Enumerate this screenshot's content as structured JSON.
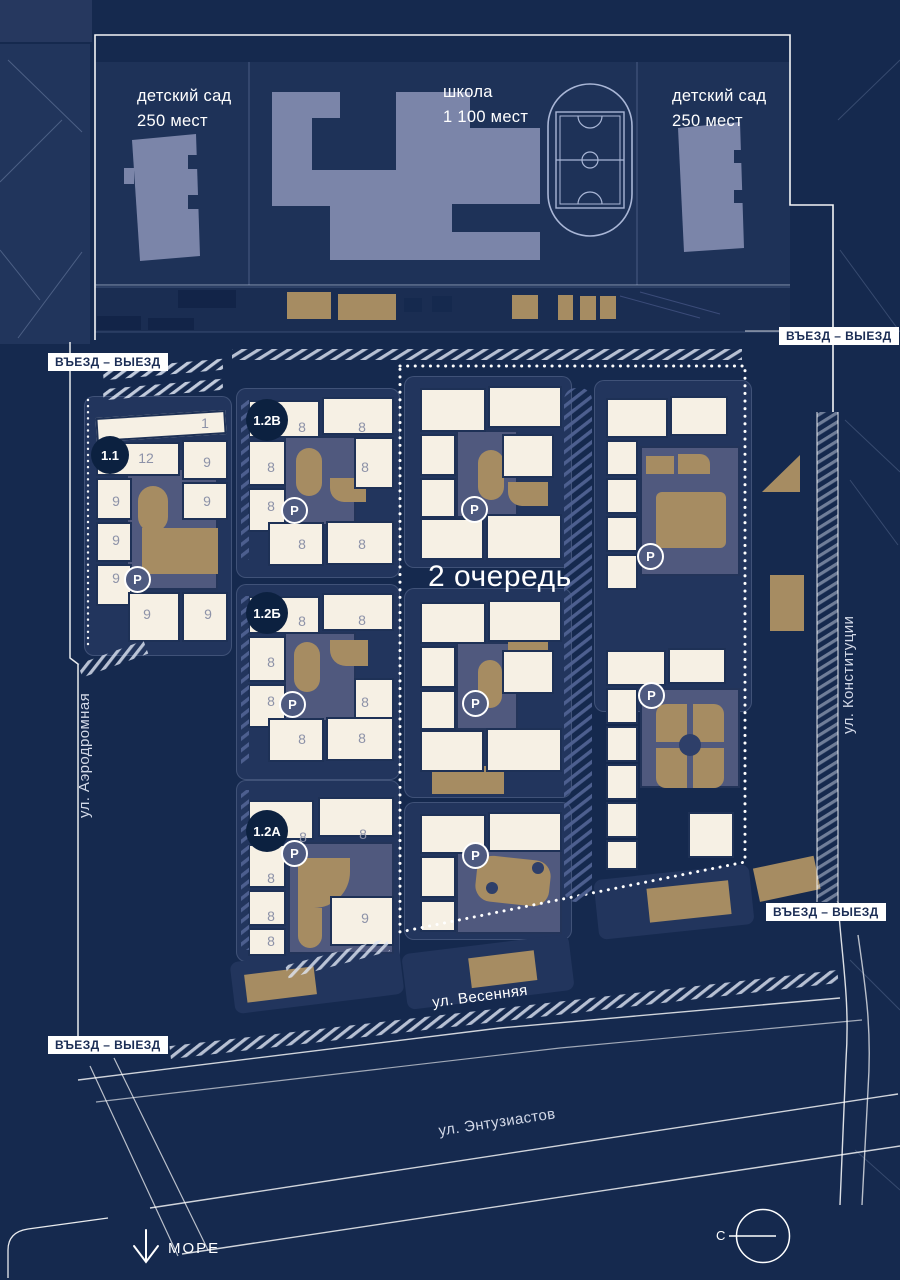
{
  "colors": {
    "background": "#15294e",
    "building": "#f6f0e4",
    "playground_tan": "#a68c62",
    "courtyard": "#50597e",
    "edu_building": "#7b85a9",
    "badge": "#0c2140",
    "accent_white": "#ffffff"
  },
  "facilities": {
    "kg_left": {
      "line1": "детский сад",
      "line2": "250 мест"
    },
    "school": {
      "line1": "школа",
      "line2": "1 100 мест"
    },
    "kg_right": {
      "line1": "детский сад",
      "line2": "250 мест"
    }
  },
  "entrance_label": "ВЪЕЗД – ВЫЕЗД",
  "phase2_label": "2 очередь",
  "streets": {
    "aerodromnaya": "ул. Аэродромная",
    "konstitutsii": "ул. Конституции",
    "vesennyaya": "ул. Весенняя",
    "entuziastov": "ул. Энтузиастов"
  },
  "sea_label": "МОРЕ",
  "north_label": "С",
  "parking_label": "P",
  "blocks": {
    "b11": {
      "badge": "1.1",
      "floors": [
        "1",
        "12",
        "9",
        "9",
        "9",
        "9",
        "9",
        "9",
        "9"
      ]
    },
    "b12v": {
      "badge": "1.2В",
      "floors": [
        "8",
        "8",
        "8",
        "8",
        "8",
        "8",
        "8"
      ]
    },
    "b12b": {
      "badge": "1.2Б",
      "floors": [
        "8",
        "8",
        "8",
        "8",
        "8",
        "8",
        "8"
      ]
    },
    "b12a": {
      "badge": "1.2А",
      "floors": [
        "8",
        "8",
        "8",
        "8",
        "8",
        "9"
      ]
    }
  }
}
